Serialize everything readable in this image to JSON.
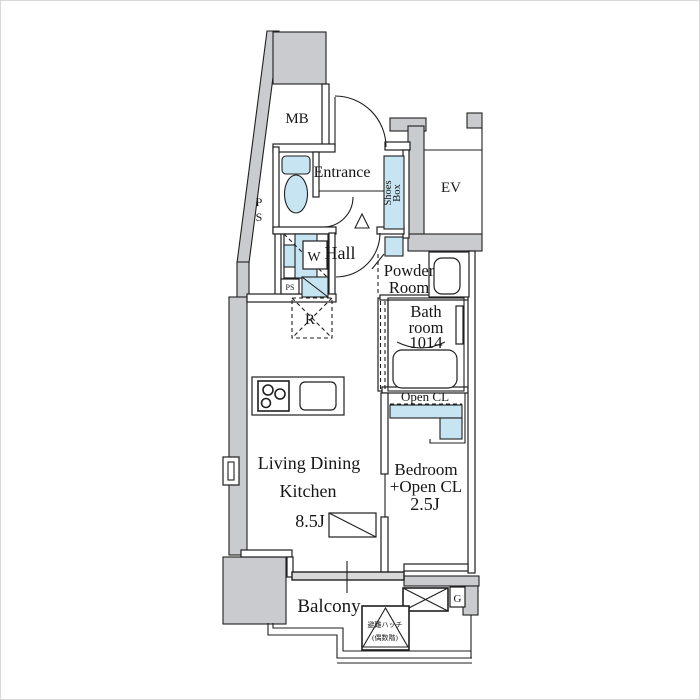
{
  "colors": {
    "wall": "#c9cbce",
    "fixture": "#c7e4f2",
    "line": "#1f1f1f",
    "window": "#d9d9d9",
    "bg": "#ffffff"
  },
  "labels": {
    "mb": "MB",
    "entrance": "Entrance",
    "hall": "Hall",
    "shoes_line1": "Shoes",
    "shoes_line2": "Box",
    "ev": "EV",
    "ps_p": "P",
    "ps_s": "S",
    "ps_small": "PS",
    "washer": "W",
    "fridge": "R",
    "powder_line1": "Powder",
    "powder_line2": "Room",
    "bath_line1": "Bath",
    "bath_line2": "room",
    "bath_line3": "1014",
    "open_cl": "Open CL",
    "ldk_line1": "Living Dining",
    "ldk_line2": "Kitchen",
    "ldk_size": "8.5J",
    "bedroom_line1": "Bedroom",
    "bedroom_line2": "+Open CL",
    "bedroom_size": "2.5J",
    "balcony": "Balcony",
    "gas": "G",
    "hatch_line1": "避難ハッチ",
    "hatch_line2": "(偶数階)"
  }
}
